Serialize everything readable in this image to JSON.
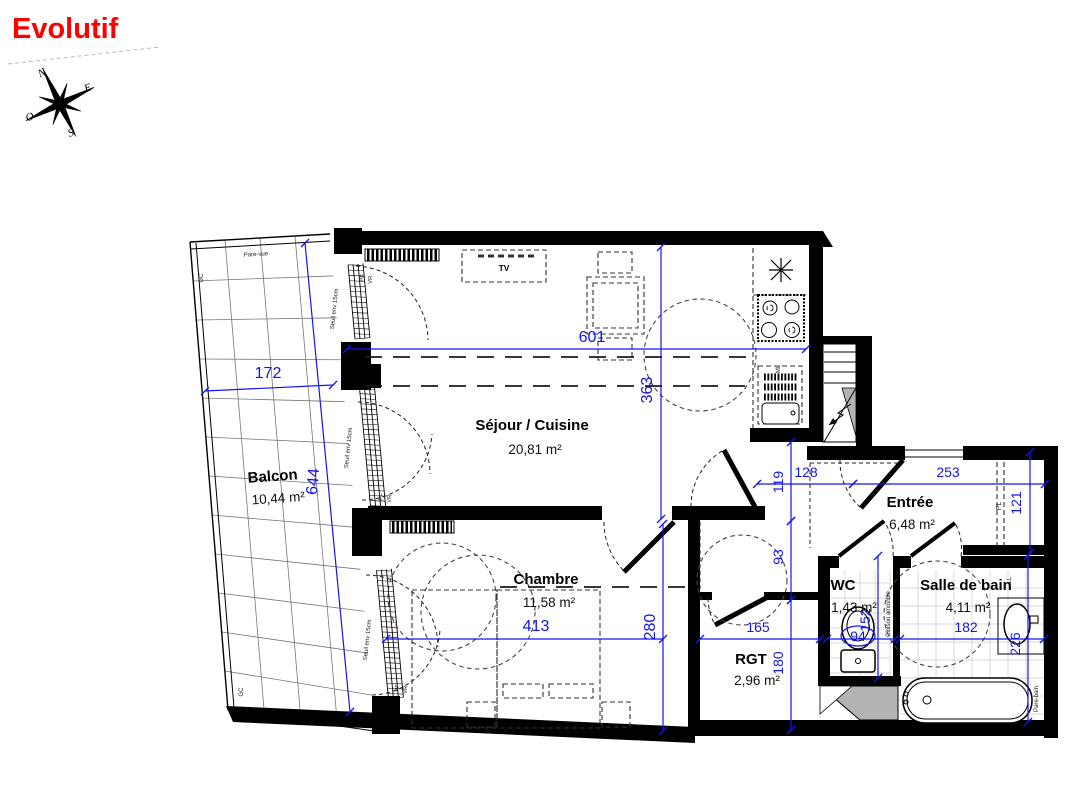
{
  "title": "Evolutif",
  "compass": {
    "north": "N",
    "south": "S",
    "east": "E",
    "west": "O"
  },
  "rooms": {
    "balcony": {
      "name": "Balcon",
      "area": "10,44 m²"
    },
    "living_kitchen": {
      "name": "Séjour / Cuisine",
      "area": "20,81 m²"
    },
    "bedroom": {
      "name": "Chambre",
      "area": "11,58 m²"
    },
    "entry": {
      "name": "Entrée",
      "area": "6,48 m²"
    },
    "wc": {
      "name": "WC",
      "area": "1,43 m²"
    },
    "bathroom": {
      "name": "Salle de bain",
      "area": "4,11 m²"
    },
    "storage": {
      "name": "RGT",
      "area": "2,96 m²"
    }
  },
  "dimensions_cm": {
    "balcony_width": "172",
    "balcony_length": "644",
    "living_width": "601",
    "living_depth": "363",
    "bedroom_width": "413",
    "bedroom_depth": "280",
    "storage_width": "165",
    "storage_depth": "180",
    "wc_width": "94",
    "wc_depth": "152",
    "bathroom_width": "182",
    "bathroom_depth": "226",
    "hall_depth": "93",
    "passage_depth": "119",
    "entry_width_left": "128",
    "entry_width_right": "253",
    "closet_depth": "121"
  },
  "annotations": {
    "tv": "TV",
    "washing_machine": "ML",
    "linen": "LL",
    "closet": "PL",
    "french_door": "PF",
    "roller_shutter": "VR",
    "threshold": "Seuil env 15cm",
    "guardrail": "GC",
    "privacy_screen": "Pare-vue",
    "removable_partition": "Cloison amovible",
    "bath_screen": "Pare-bain"
  },
  "colors": {
    "title": "#ff0000",
    "dimension": "#1414ee",
    "wall": "#000000",
    "duct": "#b3b3b3"
  }
}
